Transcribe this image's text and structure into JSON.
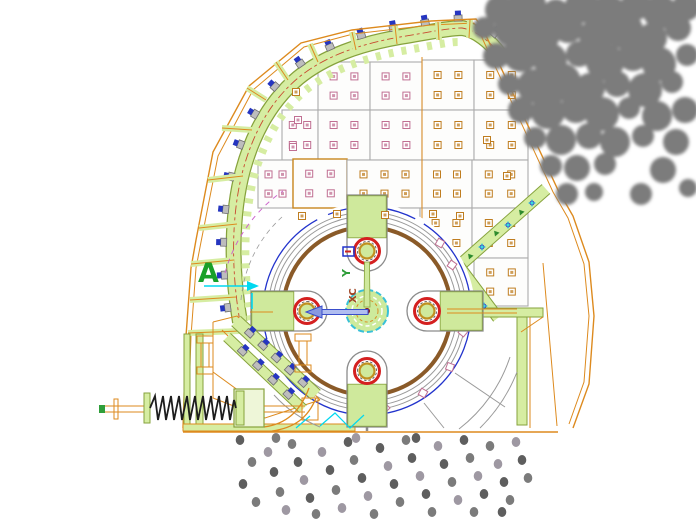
{
  "labels": {
    "section_marker": "A",
    "ucs_y_label": "Y",
    "ucs_xc_label": "XC"
  },
  "colors": {
    "housing": "#dd8a1e",
    "liner_fill": "#d6eda2",
    "liner_edge": "#86a23c",
    "centerline": "#c84a30",
    "panel_edge": "#ababab",
    "panel_fill": "#fdfdfc",
    "panel_edge_orange": "#c8861e",
    "bolt_pink": "#c06f92",
    "bolt_orange": "#bf7d20",
    "bolt_gray": "#bdbdbd",
    "bolt_gray_edge": "#6e6e6e",
    "bolt_blue": "#2535c0",
    "rotor_gray": "#9a9a9a",
    "rotor_brown": "#8a5a28",
    "rotor_blue": "#2233cc",
    "hammer_red": "#d42020",
    "hammer_ring_yellow": "#c09020",
    "hammer_green": "#cfe99c",
    "hammer_outline": "#8c8c8c",
    "hub_fill": "#cdea9c",
    "hub_cyan": "#38c0d8",
    "hub_dash_orange": "#d89028",
    "center_red": "#8a1212",
    "axis_green": "#2f9e3a",
    "arrow_blue_dark": "#3a4ecc",
    "arrow_blue_light": "#b0bdf0",
    "cyan": "#00d8f0",
    "magenta": "#cc66cc",
    "rock": "#7c7c7c",
    "spring": "#1d1d1d",
    "label_green": "#18a028"
  },
  "figure": {
    "dot_shades": [
      "#5e5e5e",
      "#7b7b7b",
      "#9e98a2"
    ],
    "rocks": [
      [
        500,
        10,
        15
      ],
      [
        527,
        5,
        19
      ],
      [
        556,
        12,
        13
      ],
      [
        582,
        6,
        17
      ],
      [
        608,
        14,
        19
      ],
      [
        636,
        5,
        15
      ],
      [
        660,
        12,
        17
      ],
      [
        686,
        7,
        14
      ],
      [
        484,
        28,
        11
      ],
      [
        510,
        30,
        16
      ],
      [
        539,
        34,
        21
      ],
      [
        568,
        28,
        15
      ],
      [
        596,
        36,
        17
      ],
      [
        624,
        30,
        19
      ],
      [
        652,
        38,
        15
      ],
      [
        678,
        28,
        13
      ],
      [
        496,
        56,
        13
      ],
      [
        521,
        54,
        18
      ],
      [
        550,
        60,
        17
      ],
      [
        579,
        54,
        13
      ],
      [
        605,
        62,
        19
      ],
      [
        633,
        56,
        15
      ],
      [
        659,
        64,
        17
      ],
      [
        687,
        55,
        11
      ],
      [
        509,
        84,
        11
      ],
      [
        534,
        86,
        17
      ],
      [
        562,
        82,
        19
      ],
      [
        590,
        88,
        15
      ],
      [
        617,
        84,
        13
      ],
      [
        645,
        90,
        17
      ],
      [
        672,
        82,
        11
      ],
      [
        521,
        110,
        13
      ],
      [
        548,
        112,
        17
      ],
      [
        576,
        108,
        15
      ],
      [
        602,
        114,
        17
      ],
      [
        629,
        108,
        11
      ],
      [
        657,
        116,
        15
      ],
      [
        685,
        110,
        13
      ],
      [
        535,
        138,
        11
      ],
      [
        561,
        140,
        15
      ],
      [
        589,
        136,
        13
      ],
      [
        615,
        142,
        15
      ],
      [
        643,
        136,
        11
      ],
      [
        676,
        142,
        13
      ],
      [
        551,
        166,
        11
      ],
      [
        577,
        168,
        13
      ],
      [
        605,
        164,
        11
      ],
      [
        663,
        170,
        13
      ],
      [
        567,
        194,
        11
      ],
      [
        594,
        192,
        9
      ],
      [
        641,
        194,
        11
      ],
      [
        688,
        188,
        9
      ]
    ],
    "dots": [
      [
        240,
        440,
        0
      ],
      [
        252,
        462,
        1
      ],
      [
        243,
        484,
        0
      ],
      [
        256,
        502,
        1
      ],
      [
        268,
        452,
        2
      ],
      [
        274,
        472,
        0
      ],
      [
        280,
        492,
        1
      ],
      [
        286,
        510,
        2
      ],
      [
        292,
        444,
        1
      ],
      [
        298,
        462,
        0
      ],
      [
        304,
        480,
        2
      ],
      [
        310,
        498,
        0
      ],
      [
        316,
        514,
        1
      ],
      [
        322,
        452,
        2
      ],
      [
        330,
        470,
        0
      ],
      [
        336,
        490,
        1
      ],
      [
        342,
        508,
        2
      ],
      [
        348,
        442,
        0
      ],
      [
        354,
        460,
        1
      ],
      [
        362,
        478,
        0
      ],
      [
        368,
        496,
        2
      ],
      [
        374,
        514,
        1
      ],
      [
        380,
        448,
        0
      ],
      [
        388,
        466,
        2
      ],
      [
        394,
        484,
        0
      ],
      [
        400,
        502,
        1
      ],
      [
        406,
        440,
        1
      ],
      [
        412,
        458,
        0
      ],
      [
        420,
        476,
        2
      ],
      [
        426,
        494,
        0
      ],
      [
        432,
        512,
        1
      ],
      [
        438,
        446,
        2
      ],
      [
        444,
        464,
        0
      ],
      [
        452,
        482,
        1
      ],
      [
        458,
        500,
        2
      ],
      [
        464,
        440,
        0
      ],
      [
        470,
        458,
        1
      ],
      [
        478,
        476,
        2
      ],
      [
        484,
        494,
        0
      ],
      [
        490,
        446,
        1
      ],
      [
        498,
        464,
        2
      ],
      [
        504,
        482,
        0
      ],
      [
        510,
        500,
        1
      ],
      [
        516,
        442,
        2
      ],
      [
        522,
        460,
        0
      ],
      [
        528,
        478,
        1
      ],
      [
        276,
        438,
        1
      ],
      [
        356,
        438,
        2
      ],
      [
        416,
        438,
        0
      ],
      [
        474,
        512,
        1
      ],
      [
        502,
        512,
        0
      ]
    ],
    "panels": [
      [
        422,
        60,
        52,
        50,
        "orange",
        "gray"
      ],
      [
        474,
        60,
        54,
        50,
        "orange",
        "gray"
      ],
      [
        318,
        62,
        52,
        48,
        "pink",
        "gray"
      ],
      [
        370,
        62,
        52,
        48,
        "pink",
        "gray"
      ],
      [
        282,
        110,
        36,
        50,
        "pink",
        "gray"
      ],
      [
        318,
        110,
        52,
        50,
        "pink",
        "gray"
      ],
      [
        370,
        110,
        52,
        50,
        "pink",
        "gray"
      ],
      [
        422,
        110,
        52,
        50,
        "orange",
        "gray"
      ],
      [
        474,
        110,
        54,
        50,
        "orange",
        "gray"
      ],
      [
        258,
        160,
        35,
        48,
        "pink",
        "gray"
      ],
      [
        293,
        159,
        54,
        49,
        "pink",
        "orangeEdge"
      ],
      [
        347,
        160,
        75,
        48,
        "orange",
        "gray"
      ],
      [
        422,
        160,
        50,
        48,
        "orange",
        "gray"
      ],
      [
        472,
        160,
        56,
        48,
        "orange",
        "gray"
      ],
      [
        347,
        208,
        73,
        50,
        "orange",
        "gray"
      ],
      [
        420,
        208,
        52,
        50,
        "orange",
        "gray"
      ],
      [
        472,
        208,
        56,
        50,
        "orange",
        "gray"
      ],
      [
        474,
        258,
        54,
        48,
        "orange",
        "gray"
      ]
    ],
    "extra_bolts": [
      [
        302,
        216,
        "orange"
      ],
      [
        337,
        214,
        "orange"
      ],
      [
        385,
        215,
        "orange"
      ],
      [
        433,
        214,
        "orange"
      ],
      [
        460,
        216,
        "orange"
      ],
      [
        487,
        140,
        "orange"
      ],
      [
        507,
        176,
        "orange"
      ],
      [
        298,
        120,
        "pink"
      ],
      [
        293,
        147,
        "pink"
      ],
      [
        296,
        92,
        "orange"
      ]
    ],
    "pink_squares": [
      [
        285,
        365,
        40
      ],
      [
        313,
        392,
        30
      ],
      [
        352,
        403,
        15
      ],
      [
        385,
        408,
        45
      ],
      [
        423,
        393,
        30
      ],
      [
        450,
        367,
        20
      ],
      [
        463,
        332,
        40
      ],
      [
        469,
        298,
        25
      ],
      [
        452,
        265,
        35
      ],
      [
        440,
        243,
        30
      ]
    ],
    "liner_bolt_count": 15,
    "grate_bands": [
      {
        "x1": 236,
        "y1": 321,
        "x2": 316,
        "y2": 395,
        "w": 13,
        "n": 5
      },
      {
        "x1": 227,
        "y1": 337,
        "x2": 303,
        "y2": 409,
        "w": 10,
        "n": 4
      }
    ],
    "chute_strips": [
      {
        "x1": 546,
        "y1": 189,
        "x2": 459,
        "y2": 266,
        "w": 12
      },
      {
        "x1": 459,
        "y1": 266,
        "x2": 498,
        "y2": 318,
        "w": 11
      }
    ],
    "cyan_glyphs": [
      [
        532,
        203
      ],
      [
        508,
        225
      ],
      [
        482,
        247
      ],
      [
        468,
        287
      ],
      [
        484,
        306
      ]
    ],
    "green_chevrons": [
      [
        521,
        212
      ],
      [
        496,
        233
      ],
      [
        470,
        256
      ],
      [
        463,
        280
      ]
    ],
    "hammers": [
      {
        "x": 367,
        "y": 251,
        "rot": 0
      },
      {
        "x": 427,
        "y": 311,
        "rot": 90
      },
      {
        "x": 367,
        "y": 371,
        "rot": 180
      },
      {
        "x": 307,
        "y": 311,
        "rot": 270
      }
    ]
  }
}
